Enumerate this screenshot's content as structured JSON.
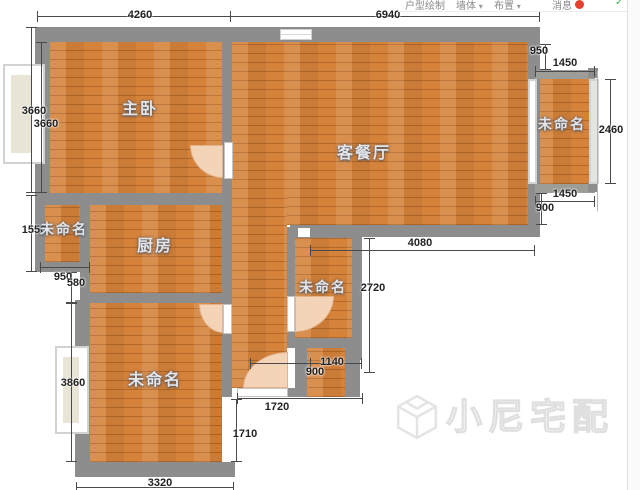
{
  "top_bar": {
    "items": [
      {
        "label": "户型绘制"
      },
      {
        "label": "墙体"
      },
      {
        "label": "布置"
      },
      {
        "label": "消息"
      }
    ],
    "caret": "▾",
    "check_icon": "✓"
  },
  "rooms": {
    "master_bedroom": "主卧",
    "living_dining": "客餐厅",
    "kitchen": "厨房",
    "unnamed_left": "未命名",
    "unnamed_right": "未命名",
    "unnamed_middle": "未命名",
    "unnamed_bottom": "未命名"
  },
  "dimensions": {
    "top_4260": "4260",
    "top_6940": "6940",
    "right_950": "950",
    "right_1450_top": "1450",
    "right_2460": "2460",
    "right_1450_bottom": "1450",
    "right_900": "900",
    "left_3660_a": "3660",
    "left_3660_b": "3660",
    "left_1550": "1550",
    "left_950": "950",
    "left_580": "580",
    "left_3860": "3860",
    "mid_4080": "4080",
    "mid_2720": "2720",
    "mid_1140": "1140",
    "mid_900": "900",
    "bottom_1720": "1720",
    "bottom_1710": "1710",
    "bottom_3320": "3320"
  },
  "watermark": {
    "text": "小尼宅配"
  },
  "colors": {
    "floor": "#d5823a",
    "wall": "#8d8d8d",
    "dimension_line": "#4a4a4a",
    "badge_red": "#e5402e",
    "icon_green": "#44a948"
  }
}
